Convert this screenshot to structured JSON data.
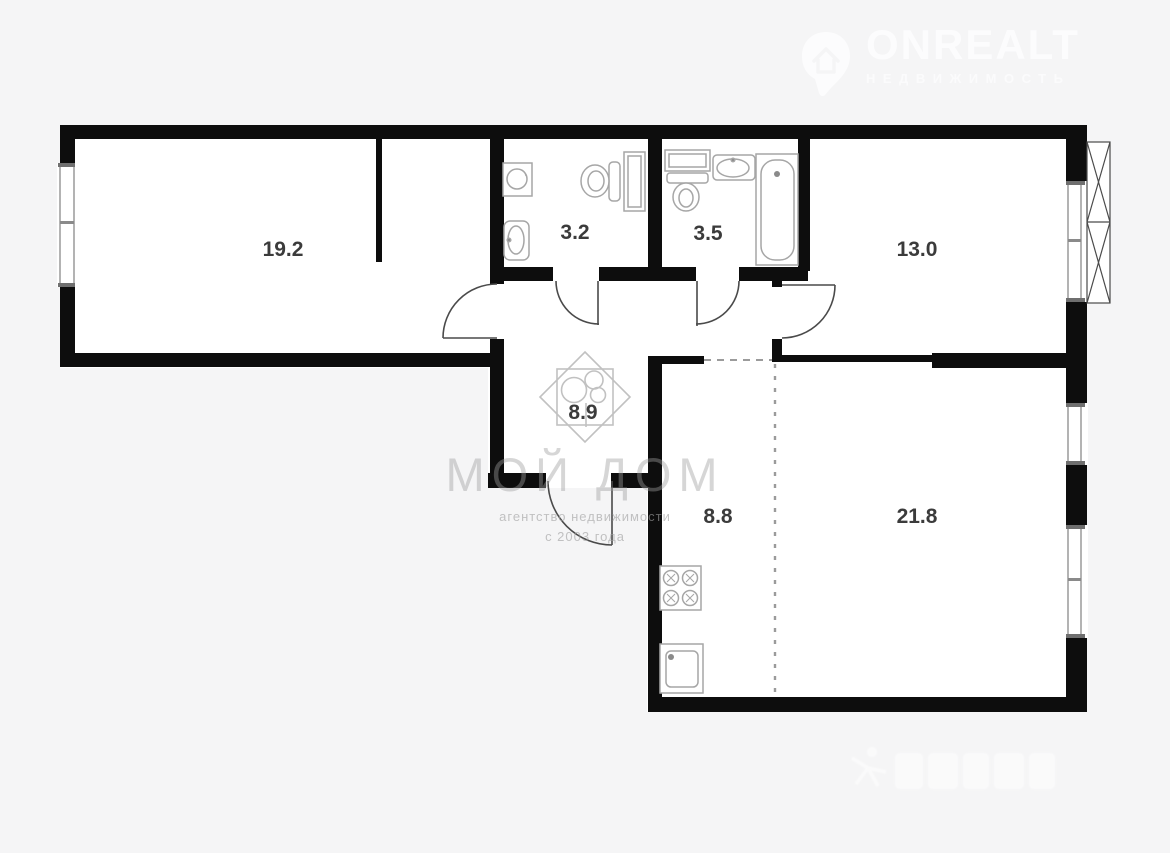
{
  "canvas": {
    "width": 1170,
    "height": 853,
    "background": "#f5f5f6"
  },
  "palette": {
    "wall": "#0d0d0d",
    "room_fill": "#ffffff",
    "fixture_line": "#a6a6a6",
    "door_line": "#4a4a4a",
    "dashed_line": "#9b9b9b",
    "label_text": "#3b3b3b",
    "logo_white": "#fcfcfd",
    "watermark_gray": "#9e9e9e"
  },
  "header_logo": {
    "title": "ONREALT",
    "tagline": "НЕДВИЖИМОСТЬ",
    "icon": "map-pin-house-icon"
  },
  "rooms": [
    {
      "area_label": "19.2"
    },
    {
      "area_label": "3.2"
    },
    {
      "area_label": "3.5"
    },
    {
      "area_label": "13.0"
    },
    {
      "area_label": "8.9"
    },
    {
      "area_label": "8.8"
    },
    {
      "area_label": "21.8"
    }
  ],
  "fixtures": {
    "bathroom_3_2": [
      "washing-machine-icon",
      "sink-icon",
      "toilet-icon",
      "cabinet-icon"
    ],
    "bathroom_3_5": [
      "shelf-icon",
      "toilet-icon",
      "sink-icon",
      "bathtub-icon"
    ],
    "kitchen_8_8": [
      "stove-icon",
      "kitchen-sink-icon"
    ],
    "hall_8_9": [
      "diamond-clover-emblem-icon"
    ]
  },
  "watermark_center": {
    "title": "МОЙ ДОМ",
    "subtitle": "агентство недвижимости",
    "since": "с 2003 года"
  }
}
